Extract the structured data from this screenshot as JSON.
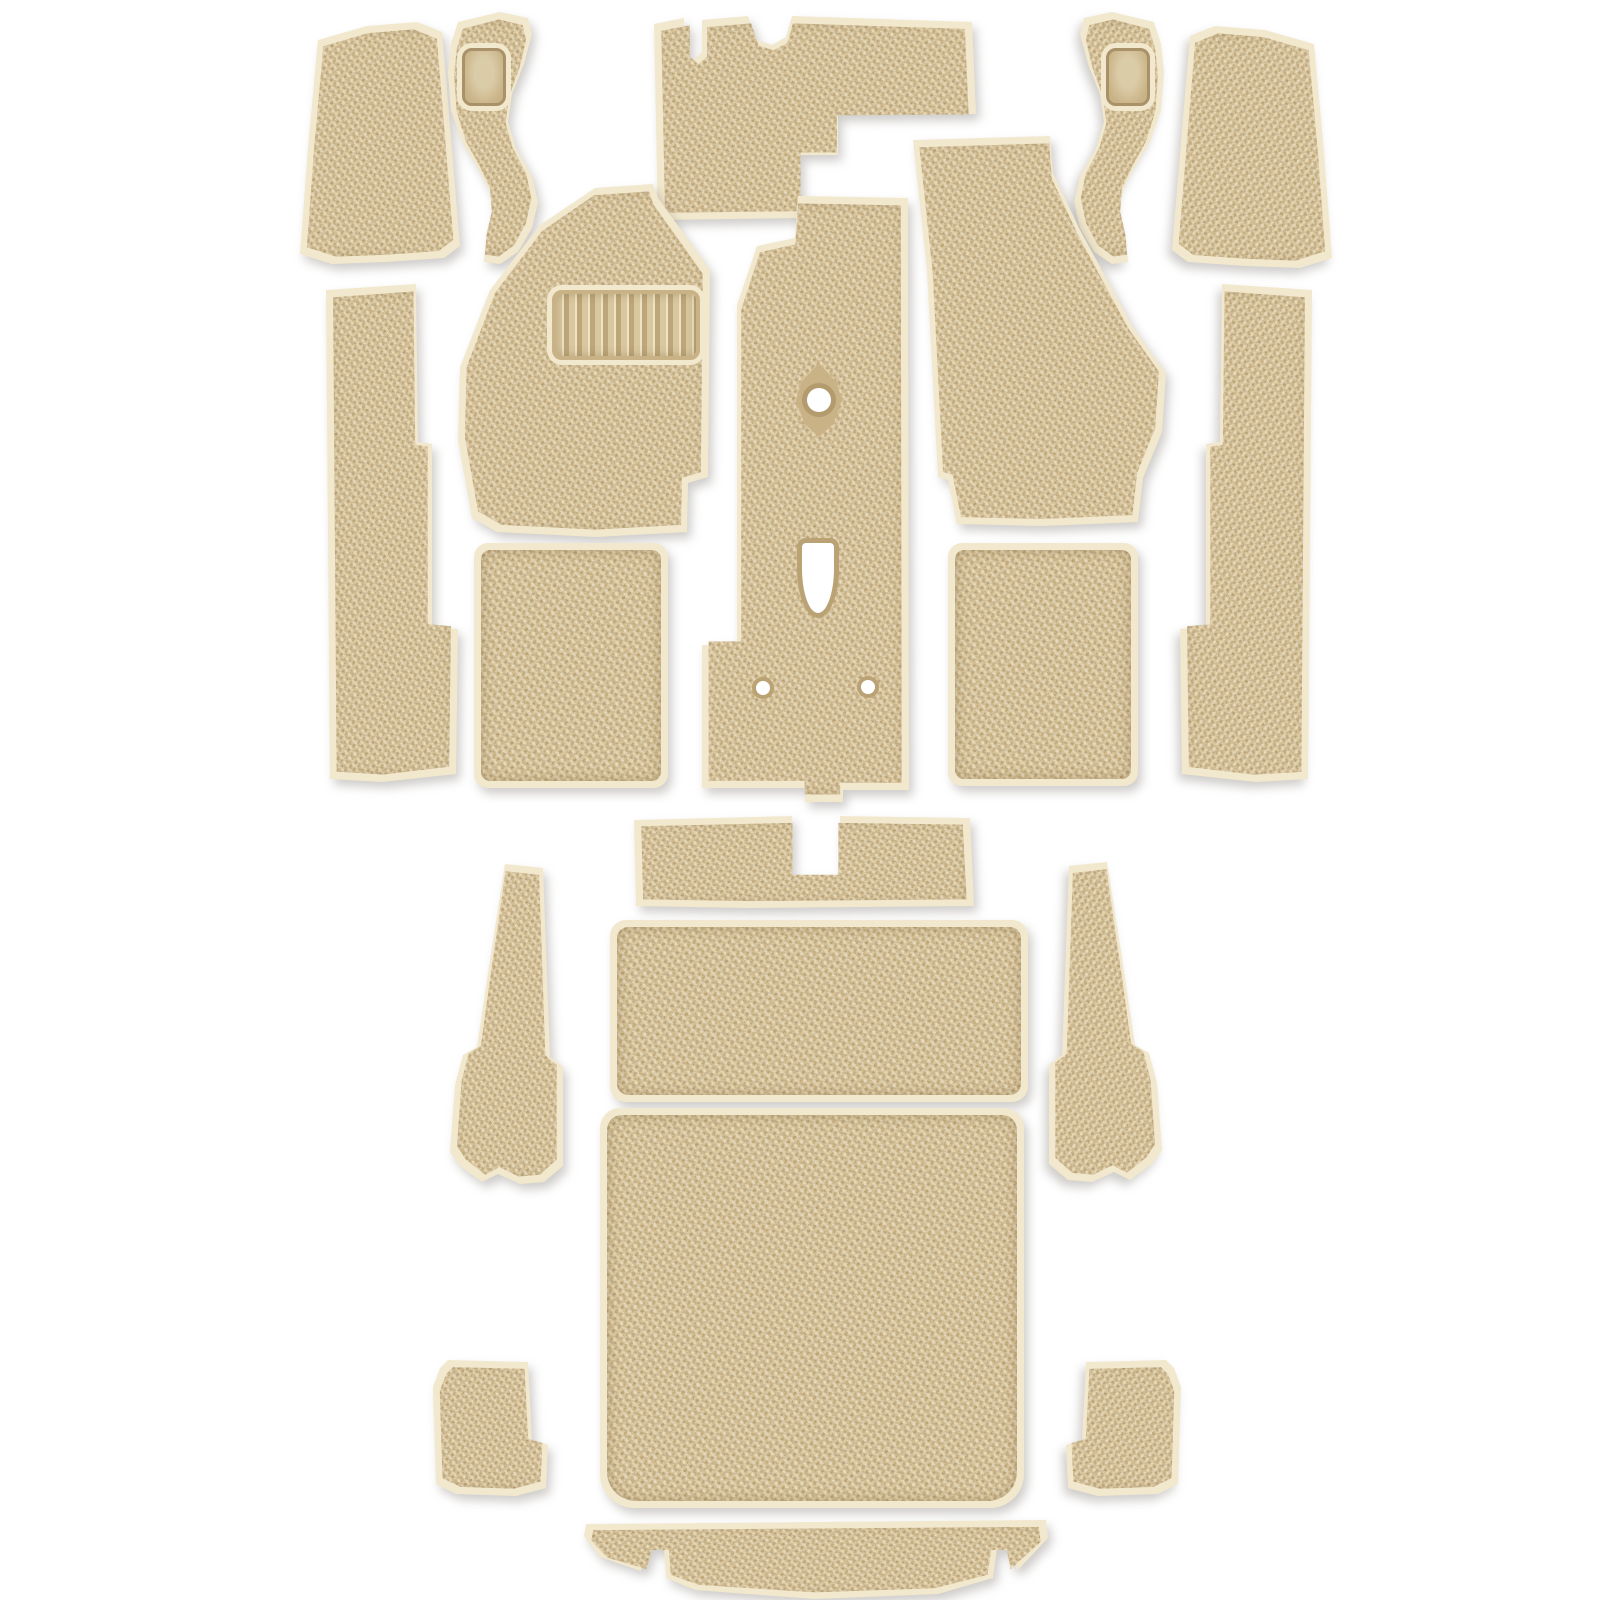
{
  "photo": {
    "kind": "product-photo",
    "subject": "molded-carpet-kit",
    "piece_count": 20
  },
  "colors": {
    "background": "#ffffff",
    "carpet_base": "#d2bc90",
    "carpet_light": "#efe5c8",
    "carpet_dark": "#a98e60",
    "binding": "#f2e8cd",
    "binding_edge": "#d8c49c",
    "vinyl_pad": "#c9b286",
    "vinyl_pad_light": "#dbcca8",
    "vinyl_pad_dark": "#a9916a",
    "grommet_ring": "#bba274",
    "shadow": "rgba(96,90,78,0.30)"
  },
  "pieces": [
    {
      "name": "piece-cowl-side-left",
      "x": 292,
      "y": 20,
      "w": 178,
      "h": 246,
      "poly": [
        [
          26,
          20
        ],
        [
          75,
          6
        ],
        [
          125,
          2
        ],
        [
          150,
          12
        ],
        [
          155,
          70
        ],
        [
          168,
          226
        ],
        [
          152,
          238
        ],
        [
          95,
          242
        ],
        [
          40,
          244
        ],
        [
          8,
          234
        ],
        [
          16,
          128
        ]
      ]
    },
    {
      "name": "piece-kick-panel-left",
      "x": 438,
      "y": 12,
      "w": 106,
      "h": 252,
      "poly": [
        [
          20,
          10
        ],
        [
          62,
          0
        ],
        [
          90,
          6
        ],
        [
          94,
          22
        ],
        [
          86,
          52
        ],
        [
          74,
          82
        ],
        [
          70,
          110
        ],
        [
          78,
          136
        ],
        [
          94,
          164
        ],
        [
          100,
          190
        ],
        [
          94,
          216
        ],
        [
          80,
          240
        ],
        [
          62,
          252
        ],
        [
          46,
          250
        ],
        [
          48,
          228
        ],
        [
          54,
          204
        ],
        [
          52,
          180
        ],
        [
          40,
          156
        ],
        [
          24,
          130
        ],
        [
          13,
          98
        ],
        [
          10,
          60
        ],
        [
          13,
          32
        ]
      ],
      "features": [
        {
          "type": "vinyl-pad",
          "name": "heel-pad-left",
          "x": 24,
          "y": 36,
          "w": 44,
          "h": 58
        }
      ]
    },
    {
      "name": "piece-toe-board-center",
      "x": 648,
      "y": 14,
      "w": 332,
      "h": 212,
      "poly": [
        [
          6,
          10
        ],
        [
          36,
          4
        ],
        [
          36,
          38
        ],
        [
          45,
          46
        ],
        [
          54,
          38
        ],
        [
          54,
          6
        ],
        [
          100,
          2
        ],
        [
          108,
          26
        ],
        [
          124,
          31
        ],
        [
          138,
          23
        ],
        [
          144,
          2
        ],
        [
          324,
          8
        ],
        [
          328,
          100
        ],
        [
          190,
          101
        ],
        [
          190,
          141
        ],
        [
          152,
          141
        ],
        [
          152,
          204
        ],
        [
          10,
          206
        ]
      ]
    },
    {
      "name": "piece-kick-panel-right",
      "x": 1068,
      "y": 12,
      "w": 106,
      "h": 252,
      "mirror": true,
      "poly": [
        [
          20,
          10
        ],
        [
          62,
          0
        ],
        [
          90,
          6
        ],
        [
          94,
          22
        ],
        [
          86,
          52
        ],
        [
          74,
          82
        ],
        [
          70,
          110
        ],
        [
          78,
          136
        ],
        [
          94,
          164
        ],
        [
          100,
          190
        ],
        [
          94,
          216
        ],
        [
          80,
          240
        ],
        [
          62,
          252
        ],
        [
          46,
          250
        ],
        [
          48,
          228
        ],
        [
          54,
          204
        ],
        [
          52,
          180
        ],
        [
          40,
          156
        ],
        [
          24,
          130
        ],
        [
          13,
          98
        ],
        [
          10,
          60
        ],
        [
          13,
          32
        ]
      ],
      "features": [
        {
          "type": "vinyl-pad",
          "name": "heel-pad-right",
          "x": 24,
          "y": 36,
          "w": 44,
          "h": 58
        }
      ]
    },
    {
      "name": "piece-cowl-side-right",
      "x": 1162,
      "y": 24,
      "w": 178,
      "h": 246,
      "mirror": true,
      "poly": [
        [
          26,
          20
        ],
        [
          75,
          6
        ],
        [
          125,
          2
        ],
        [
          150,
          12
        ],
        [
          155,
          70
        ],
        [
          168,
          226
        ],
        [
          152,
          238
        ],
        [
          95,
          242
        ],
        [
          40,
          244
        ],
        [
          8,
          234
        ],
        [
          16,
          128
        ]
      ]
    },
    {
      "name": "piece-rocker-left",
      "x": 322,
      "y": 282,
      "w": 140,
      "h": 502,
      "poly": [
        [
          4,
          8
        ],
        [
          94,
          2
        ],
        [
          96,
          160
        ],
        [
          110,
          162
        ],
        [
          110,
          345
        ],
        [
          136,
          347
        ],
        [
          134,
          492
        ],
        [
          60,
          500
        ],
        [
          8,
          497
        ]
      ]
    },
    {
      "name": "piece-front-footwell-left",
      "x": 446,
      "y": 182,
      "w": 268,
      "h": 358,
      "poly": [
        [
          149,
          6
        ],
        [
          207,
          2
        ],
        [
          212,
          16
        ],
        [
          233,
          45
        ],
        [
          264,
          88
        ],
        [
          262,
          295
        ],
        [
          242,
          301
        ],
        [
          241,
          350
        ],
        [
          150,
          355
        ],
        [
          51,
          350
        ],
        [
          26,
          336
        ],
        [
          12,
          258
        ],
        [
          14,
          185
        ],
        [
          44,
          108
        ],
        [
          94,
          43
        ]
      ],
      "features": [
        {
          "type": "ribbed-pad",
          "name": "ribbed-heel-pad",
          "x": 106,
          "y": 108,
          "w": 148,
          "h": 70
        }
      ]
    },
    {
      "name": "piece-tunnel",
      "x": 688,
      "y": 194,
      "w": 224,
      "h": 610,
      "poly": [
        [
          110,
          2
        ],
        [
          220,
          4
        ],
        [
          221,
          596
        ],
        [
          155,
          596
        ],
        [
          155,
          608
        ],
        [
          117,
          608
        ],
        [
          117,
          594
        ],
        [
          14,
          594
        ],
        [
          14,
          451
        ],
        [
          49,
          451
        ],
        [
          49,
          111
        ],
        [
          69,
          52
        ],
        [
          107,
          44
        ]
      ],
      "features": [
        {
          "type": "grommet",
          "name": "shifter-grommet",
          "x": 108,
          "y": 169,
          "w": 46,
          "h": 74
        },
        {
          "type": "keyhole",
          "name": "shifter-cutout",
          "x": 109,
          "y": 344,
          "w": 42,
          "h": 80
        },
        {
          "type": "hole",
          "name": "mounting-hole-left",
          "x": 64,
          "y": 483,
          "w": 22,
          "h": 22
        },
        {
          "type": "hole",
          "name": "mounting-hole-right",
          "x": 169,
          "y": 482,
          "w": 22,
          "h": 22
        }
      ]
    },
    {
      "name": "piece-front-footwell-right",
      "x": 892,
      "y": 132,
      "w": 282,
      "h": 408,
      "poly": [
        [
          21,
          8
        ],
        [
          158,
          4
        ],
        [
          161,
          41
        ],
        [
          188,
          98
        ],
        [
          241,
          195
        ],
        [
          274,
          241
        ],
        [
          270,
          300
        ],
        [
          251,
          346
        ],
        [
          246,
          390
        ],
        [
          150,
          394
        ],
        [
          65,
          392
        ],
        [
          56,
          348
        ],
        [
          46,
          345
        ],
        [
          35,
          138
        ]
      ]
    },
    {
      "name": "piece-rocker-right",
      "x": 1176,
      "y": 282,
      "w": 140,
      "h": 508,
      "mirror": true,
      "poly": [
        [
          4,
          8
        ],
        [
          94,
          2
        ],
        [
          96,
          160
        ],
        [
          110,
          162
        ],
        [
          110,
          345
        ],
        [
          136,
          347
        ],
        [
          134,
          492
        ],
        [
          60,
          500
        ],
        [
          8,
          497
        ]
      ]
    },
    {
      "name": "piece-rear-footwell-left",
      "x": 474,
      "y": 543,
      "w": 194,
      "h": 245,
      "radius": [
        14,
        14,
        14,
        14
      ]
    },
    {
      "name": "piece-rear-footwell-right",
      "x": 948,
      "y": 543,
      "w": 190,
      "h": 243,
      "radius": [
        14,
        14,
        14,
        14
      ]
    },
    {
      "name": "piece-seat-crossmember",
      "x": 628,
      "y": 812,
      "w": 348,
      "h": 100,
      "poly": [
        [
          6,
          8
        ],
        [
          164,
          4
        ],
        [
          164,
          65
        ],
        [
          212,
          65
        ],
        [
          212,
          4
        ],
        [
          342,
          6
        ],
        [
          346,
          94
        ],
        [
          120,
          96
        ],
        [
          8,
          94
        ]
      ]
    },
    {
      "name": "piece-wheel-arch-left",
      "x": 446,
      "y": 856,
      "w": 128,
      "h": 332,
      "poly": [
        [
          59,
          8
        ],
        [
          97,
          12
        ],
        [
          104,
          201
        ],
        [
          117,
          211
        ],
        [
          117,
          310
        ],
        [
          98,
          326
        ],
        [
          74,
          328
        ],
        [
          52,
          318
        ],
        [
          36,
          326
        ],
        [
          14,
          310
        ],
        [
          4,
          296
        ],
        [
          9,
          229
        ],
        [
          17,
          199
        ],
        [
          31,
          191
        ],
        [
          44,
          104
        ]
      ]
    },
    {
      "name": "piece-seat-riser",
      "x": 610,
      "y": 920,
      "w": 418,
      "h": 182,
      "radius": [
        16,
        16,
        16,
        16
      ]
    },
    {
      "name": "piece-wheel-arch-right",
      "x": 1038,
      "y": 854,
      "w": 128,
      "h": 334,
      "mirror": true,
      "poly": [
        [
          59,
          8
        ],
        [
          97,
          12
        ],
        [
          104,
          201
        ],
        [
          117,
          211
        ],
        [
          117,
          310
        ],
        [
          98,
          326
        ],
        [
          74,
          328
        ],
        [
          52,
          318
        ],
        [
          36,
          326
        ],
        [
          14,
          310
        ],
        [
          4,
          296
        ],
        [
          9,
          229
        ],
        [
          17,
          199
        ],
        [
          31,
          191
        ],
        [
          44,
          104
        ]
      ]
    },
    {
      "name": "piece-cargo-floor",
      "x": 600,
      "y": 1108,
      "w": 424,
      "h": 400,
      "radius": [
        20,
        20,
        34,
        34
      ]
    },
    {
      "name": "piece-rear-corner-left",
      "x": 426,
      "y": 1356,
      "w": 140,
      "h": 142,
      "poly": [
        [
          22,
          4
        ],
        [
          102,
          6
        ],
        [
          106,
          84
        ],
        [
          122,
          89
        ],
        [
          120,
          132
        ],
        [
          90,
          140
        ],
        [
          30,
          138
        ],
        [
          10,
          128
        ],
        [
          7,
          31
        ],
        [
          14,
          12
        ]
      ]
    },
    {
      "name": "piece-rear-corner-right",
      "x": 1048,
      "y": 1356,
      "w": 140,
      "h": 142,
      "mirror": true,
      "poly": [
        [
          22,
          4
        ],
        [
          102,
          6
        ],
        [
          106,
          84
        ],
        [
          122,
          89
        ],
        [
          120,
          132
        ],
        [
          90,
          140
        ],
        [
          30,
          138
        ],
        [
          10,
          128
        ],
        [
          7,
          31
        ],
        [
          14,
          12
        ]
      ]
    },
    {
      "name": "piece-tailgate-sill",
      "x": 580,
      "y": 1516,
      "w": 474,
      "h": 88,
      "poly": [
        [
          6,
          8
        ],
        [
          466,
          4
        ],
        [
          468,
          22
        ],
        [
          437,
          55
        ],
        [
          433,
          32
        ],
        [
          417,
          32
        ],
        [
          413,
          62
        ],
        [
          358,
          78
        ],
        [
          235,
          83
        ],
        [
          115,
          74
        ],
        [
          86,
          62
        ],
        [
          84,
          32
        ],
        [
          66,
          32
        ],
        [
          61,
          55
        ],
        [
          20,
          41
        ],
        [
          4,
          20
        ]
      ]
    }
  ]
}
